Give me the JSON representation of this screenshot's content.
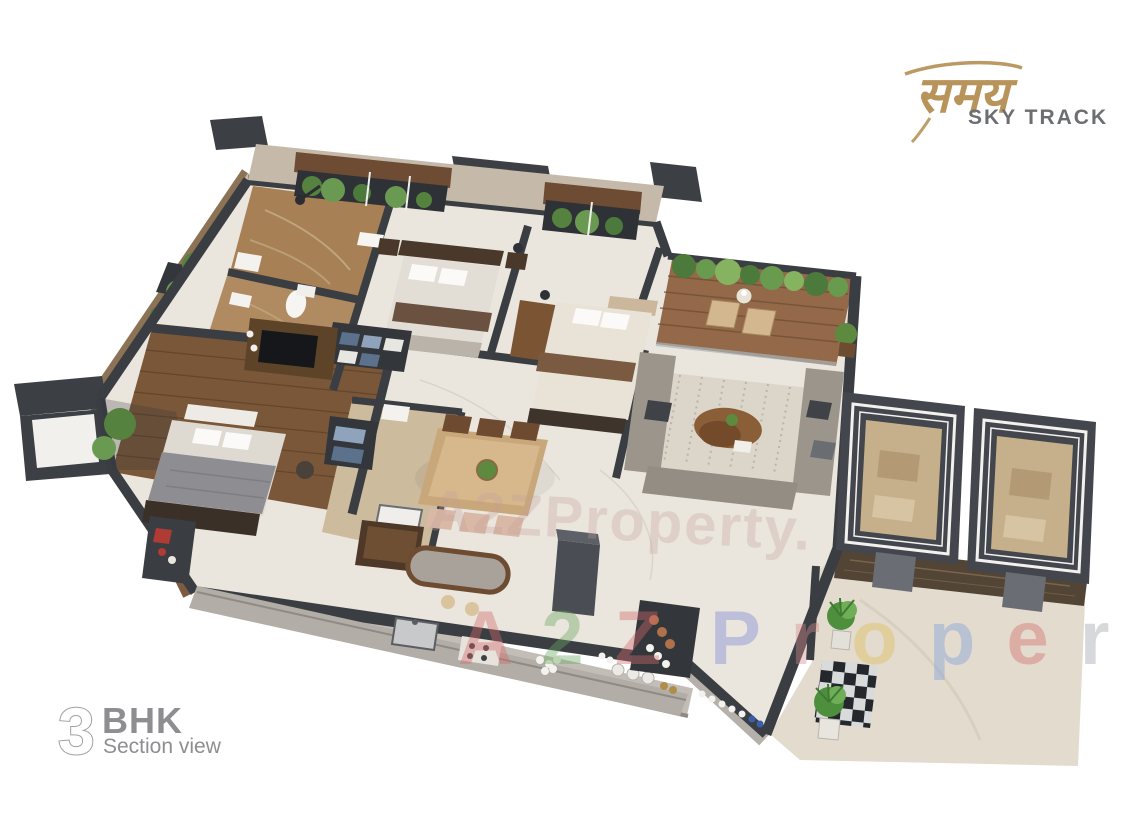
{
  "page": {
    "background": "#ffffff",
    "description": "3D isometric section-view rendering of a 3 BHK apartment floor plan"
  },
  "brand": {
    "logo_text": "समय",
    "logo_tagline": "SKY TRACK",
    "logo_color": "#b8935a",
    "tagline_color": "#6d6e71"
  },
  "caption": {
    "number": "3",
    "label": "BHK",
    "subtitle": "Section view",
    "color": "#8e8e91"
  },
  "watermarks": {
    "center": {
      "text": "A2ZProperty.",
      "color": "#c59f9a"
    },
    "bottom": {
      "letters": [
        {
          "ch": "A",
          "color": "#d46a6a"
        },
        {
          "ch": "2",
          "color": "#6aa85f"
        },
        {
          "ch": "Z",
          "color": "#d46a6a"
        },
        {
          "ch": "P",
          "color": "#7b86d8"
        },
        {
          "ch": "r",
          "color": "#d98a8a"
        },
        {
          "ch": "o",
          "color": "#e0bd55"
        },
        {
          "ch": "p",
          "color": "#7b9fd8"
        },
        {
          "ch": "e",
          "color": "#d46a6a"
        },
        {
          "ch": "r",
          "color": "#9aa0a6"
        },
        {
          "ch": "t",
          "color": "#e0bd55"
        },
        {
          "ch": "y",
          "color": "#7fb069"
        }
      ]
    }
  },
  "palette": {
    "wall": "#3a3e43",
    "floor": "#eae5dd",
    "wood_floor": "#7a5738",
    "deck": "#936949",
    "bath_marble": "#ab845c",
    "rug": "#dbd5ca",
    "sofa": "#9b958c",
    "plant": "#5d8a3e",
    "elevator_wall": "#43474d",
    "elevator_floor": "#c6b08c",
    "counter": "#b2ada6",
    "accent_wood": "#6e4a30",
    "exterior_brown": "#7d5b40"
  }
}
